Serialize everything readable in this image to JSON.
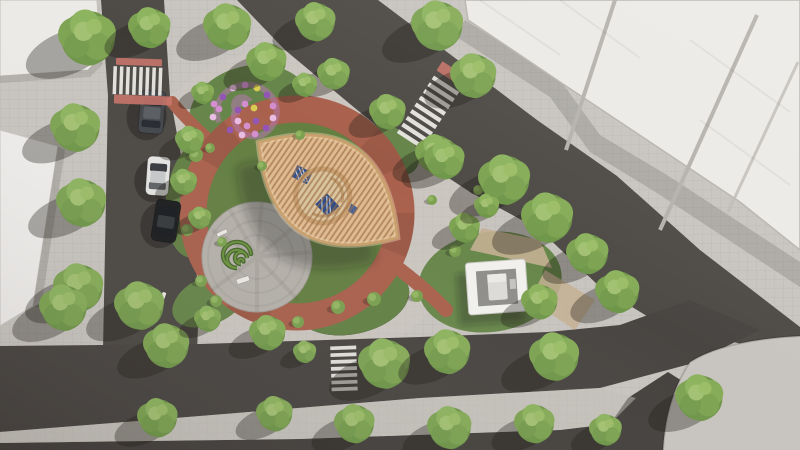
{
  "scene": {
    "description": "aerial-render-pocket-park",
    "palette": {
      "paving": "#c8c4bf",
      "paving_warm": "#d0cac2",
      "road": "#4e4a46",
      "road_dark": "#423e3b",
      "roof_white": "#eceae7",
      "roof_edge": "#b8b4af",
      "lawn": "#68874b",
      "lawn_dark": "#55713c",
      "tree_base": "#6f9449",
      "tree_light": "#8db45f",
      "tree_highlight": "#a3c172",
      "ring_red": "#a9614d",
      "tactile_pink": "#c8746a",
      "plaza_gray": "#b5b1aa",
      "pergola_wood": "#e0ba90",
      "pergola_slat": "#96693f",
      "pergola_rim": "#caa06c",
      "courtyard_sand": "#d9c4a0",
      "canopy_blue": "#31508c",
      "hedge_green": "#47682e",
      "stone_tan": "#c4b093",
      "pavilion_white": "#f1f0ed",
      "pavilion_floor": "#908e8a",
      "crosswalk_white": "#eae8e4",
      "shadow": "rgba(30,26,21,0.34)"
    },
    "trees": [
      [
        88,
        38,
        30
      ],
      [
        150,
        28,
        22
      ],
      [
        228,
        27,
        25
      ],
      [
        267,
        62,
        21
      ],
      [
        316,
        22,
        21
      ],
      [
        334,
        74,
        17
      ],
      [
        438,
        26,
        27
      ],
      [
        474,
        76,
        24
      ],
      [
        388,
        112,
        19
      ],
      [
        436,
        154,
        21
      ],
      [
        305,
        85,
        13
      ],
      [
        203,
        93,
        12
      ],
      [
        76,
        128,
        26
      ],
      [
        82,
        203,
        26
      ],
      [
        79,
        288,
        26
      ],
      [
        190,
        140,
        15
      ],
      [
        184,
        182,
        14
      ],
      [
        200,
        218,
        12
      ],
      [
        64,
        308,
        25
      ],
      [
        140,
        306,
        26
      ],
      [
        167,
        346,
        24
      ],
      [
        208,
        319,
        14
      ],
      [
        268,
        333,
        19
      ],
      [
        305,
        352,
        12
      ],
      [
        385,
        364,
        27
      ],
      [
        448,
        352,
        24
      ],
      [
        555,
        357,
        26
      ],
      [
        618,
        292,
        23
      ],
      [
        158,
        418,
        21
      ],
      [
        275,
        414,
        19
      ],
      [
        355,
        424,
        21
      ],
      [
        450,
        428,
        23
      ],
      [
        535,
        424,
        21
      ],
      [
        606,
        430,
        17
      ],
      [
        700,
        398,
        25
      ],
      [
        445,
        160,
        21
      ],
      [
        505,
        180,
        27
      ],
      [
        548,
        218,
        27
      ],
      [
        588,
        254,
        22
      ],
      [
        465,
        228,
        16
      ],
      [
        487,
        206,
        13
      ],
      [
        540,
        302,
        19
      ]
    ],
    "shrubs": [
      [
        196,
        155,
        7
      ],
      [
        187,
        230,
        6
      ],
      [
        201,
        281,
        6
      ],
      [
        216,
        301,
        6
      ],
      [
        298,
        322,
        6
      ],
      [
        338,
        307,
        7
      ],
      [
        374,
        299,
        7
      ],
      [
        417,
        296,
        6
      ],
      [
        455,
        251,
        6
      ],
      [
        300,
        135,
        5
      ],
      [
        262,
        166,
        5
      ],
      [
        222,
        242,
        5
      ],
      [
        210,
        148,
        5
      ],
      [
        432,
        200,
        5
      ],
      [
        478,
        190,
        5
      ]
    ],
    "flower_spiral": {
      "center": [
        247,
        113
      ],
      "dot_colors": [
        "#d48ed0",
        "#9355b5",
        "#e9bce4",
        "#d8cc52"
      ],
      "dots": [
        [
          -28,
          -4,
          0
        ],
        [
          -24,
          -16,
          1
        ],
        [
          -14,
          -25,
          2
        ],
        [
          -2,
          -28,
          0
        ],
        [
          10,
          -25,
          3
        ],
        [
          20,
          -18,
          1
        ],
        [
          26,
          -7,
          0
        ],
        [
          26,
          5,
          2
        ],
        [
          19,
          15,
          1
        ],
        [
          8,
          21,
          0
        ],
        [
          -5,
          22,
          2
        ],
        [
          -17,
          17,
          1
        ],
        [
          -34,
          4,
          2
        ],
        [
          -33,
          -9,
          0
        ],
        [
          9,
          8,
          1
        ],
        [
          0,
          13,
          0
        ],
        [
          -9,
          8,
          2
        ],
        [
          -9,
          -3,
          1
        ],
        [
          -2,
          -9,
          0
        ],
        [
          7,
          -5,
          3
        ]
      ]
    },
    "hedge_spiral": {
      "center": [
        237,
        263
      ]
    },
    "ring_path": {
      "cx": 297,
      "cy": 213,
      "r": 104,
      "width": 27
    },
    "pergola": {
      "cx": 328,
      "cy": 190,
      "rotation": 34.4,
      "half_length": 84,
      "half_width": 50
    },
    "plaza": {
      "cx": 257,
      "cy": 257,
      "r": 55
    },
    "pavilion": {
      "cx": 497,
      "cy": 287,
      "rotation": -4
    },
    "cars": [
      {
        "cx": 152,
        "cy": 112,
        "rot": 5,
        "w": 25,
        "h": 43,
        "body": "#43464a",
        "roof": "#5a5e63"
      },
      {
        "cx": 158,
        "cy": 176,
        "rot": 4,
        "w": 23,
        "h": 39,
        "body": "#e4e4e3",
        "roof": "#c6c8c9"
      },
      {
        "cx": 166,
        "cy": 221,
        "rot": 9,
        "w": 25,
        "h": 42,
        "body": "#1b1d1f",
        "roof": "#36393c"
      }
    ],
    "crosswalks": [
      {
        "cx": 139,
        "cy": 81,
        "rot": 2,
        "len": 52,
        "barlen": 28,
        "n": 8
      },
      {
        "cx": 427,
        "cy": 114,
        "rot": 123,
        "len": 72,
        "barlen": 30,
        "n": 9
      },
      {
        "cx": 344,
        "cy": 370,
        "rot": 88,
        "len": 48,
        "barlen": 26,
        "n": 7
      }
    ],
    "tactile_pads": [
      {
        "cx": 139,
        "cy": 62,
        "rot": 2,
        "w": 46,
        "h": 7
      },
      {
        "cx": 143,
        "cy": 100,
        "rot": 2,
        "w": 58,
        "h": 9
      },
      {
        "cx": 452,
        "cy": 74,
        "rot": 33,
        "w": 30,
        "h": 11
      }
    ],
    "benches": [
      {
        "cx": 222,
        "cy": 233,
        "w": 11,
        "h": 4,
        "rot": -25
      },
      {
        "cx": 243,
        "cy": 280,
        "w": 13,
        "h": 5,
        "rot": -18
      },
      {
        "cx": 163,
        "cy": 297,
        "w": 10,
        "h": 4,
        "rot": -70
      }
    ]
  }
}
